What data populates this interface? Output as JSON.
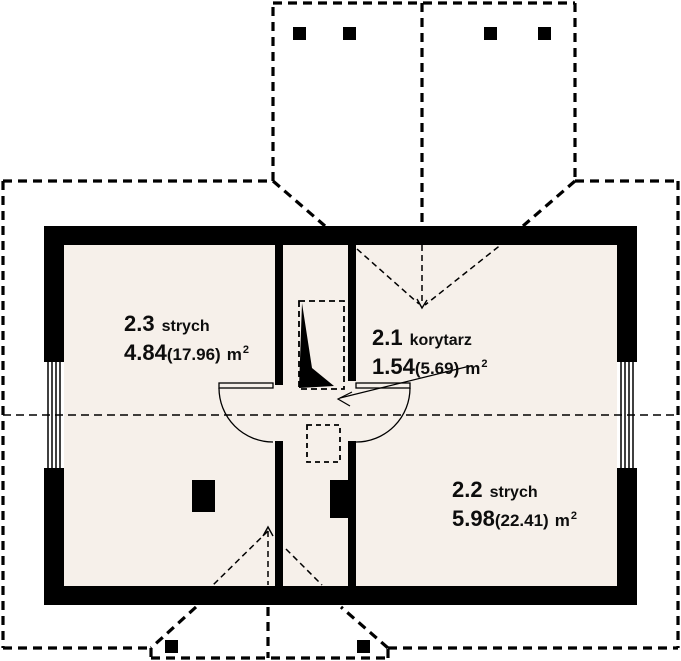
{
  "diagram": {
    "type": "floor-plan",
    "floor_fill": "#f6f0ea",
    "wall_color": "#000000",
    "line_color": "#000000",
    "background": "#ffffff",
    "rooms": [
      {
        "number": "2.3",
        "name": "strych",
        "area": "4.84",
        "area_gross": "(17.96)",
        "unit": "m",
        "unit_exp": "2"
      },
      {
        "number": "2.1",
        "name": "korytarz",
        "area": "1.54",
        "area_gross": "(5.69)",
        "unit": "m",
        "unit_exp": "2"
      },
      {
        "number": "2.2",
        "name": "strych",
        "area": "5.98",
        "area_gross": "(22.41)",
        "unit": "m",
        "unit_exp": "2"
      }
    ]
  }
}
